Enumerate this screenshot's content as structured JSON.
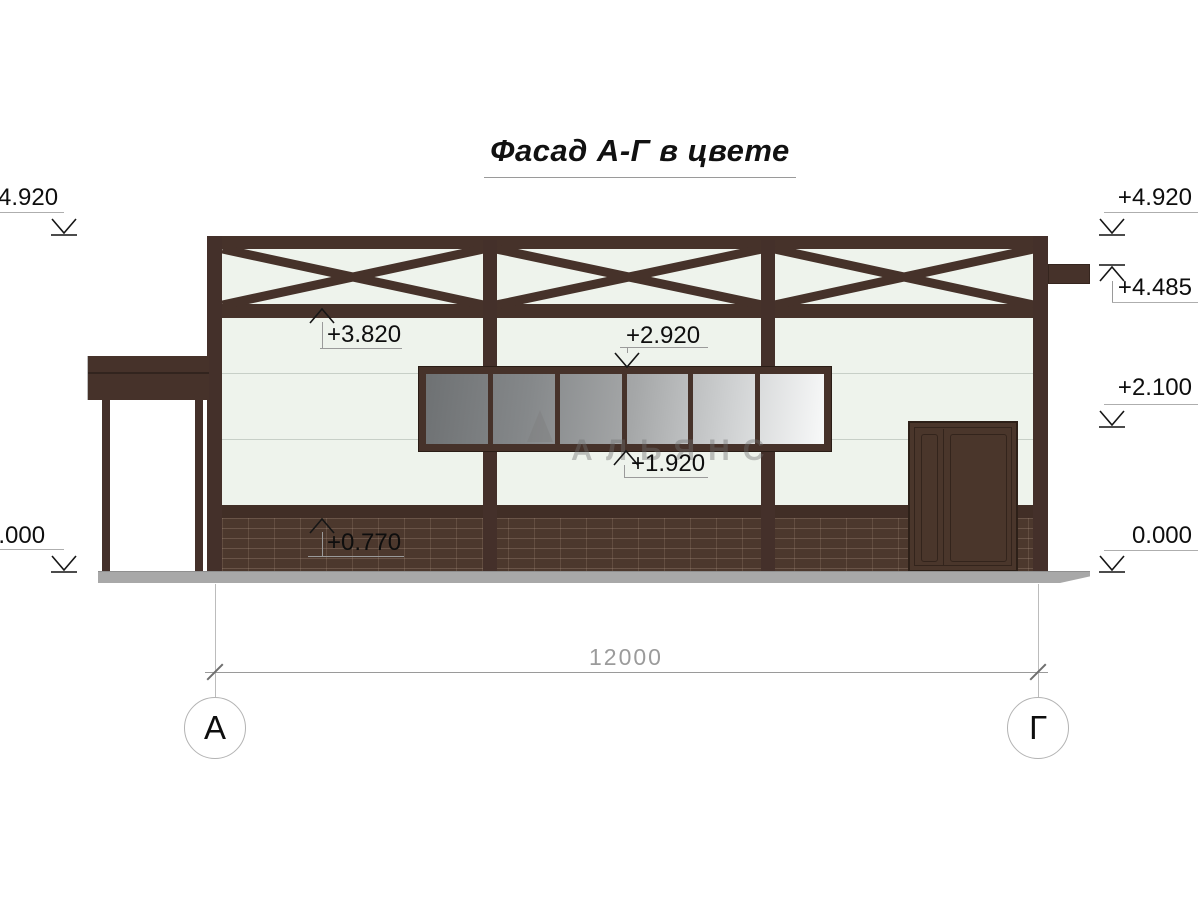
{
  "title": "Фасад А-Г в цвете",
  "watermark": {
    "text": "АЛЬЯНС"
  },
  "markers": {
    "left": [
      {
        "label": "+4.920"
      },
      {
        "label": "0.000"
      }
    ],
    "right": [
      {
        "label": "+4.920"
      },
      {
        "label": "+4.485"
      },
      {
        "label": "+2.100"
      },
      {
        "label": "0.000"
      }
    ],
    "interior": [
      {
        "label": "+3.820"
      },
      {
        "label": "+2.920"
      },
      {
        "label": "+1.920"
      },
      {
        "label": "+0.770"
      }
    ]
  },
  "dimension": {
    "value": "12000"
  },
  "axes": [
    {
      "label": "А"
    },
    {
      "label": "Г"
    }
  ],
  "colors": {
    "frame_brown": "#46322a",
    "brick_brown": "#4c382d",
    "wall_light": "#eef3ec",
    "glass_dark": "#6e7173",
    "glass_light": "#f8f9f9",
    "ground_gray": "#a8a8a8"
  }
}
